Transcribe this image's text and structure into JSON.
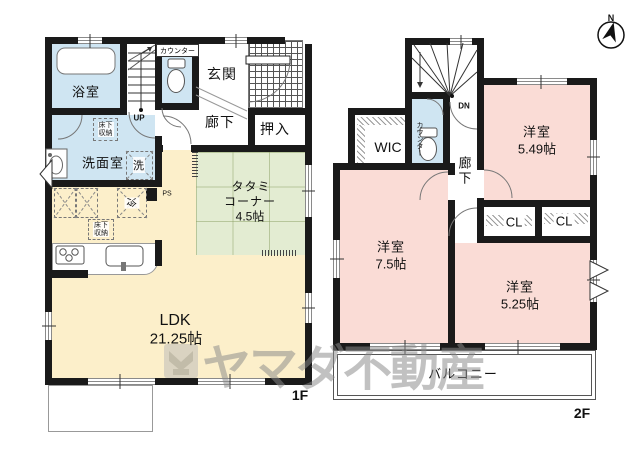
{
  "colors": {
    "wall": "#1a1a1a",
    "water_blue": "#cfe5f2",
    "tatami_green": "#e3ecd2",
    "ldk_cream": "#fcefca",
    "bedroom_pink": "#fadcd6",
    "watermark_gray": "#8a8a8a"
  },
  "compass": {
    "north_label": "N"
  },
  "watermark": {
    "company": "ヤマダ不動産"
  },
  "floor1": {
    "floor_label": "1F",
    "rooms": {
      "bathroom": "浴室",
      "washroom": "洗面室",
      "entrance": "玄関",
      "corridor": "廊下",
      "closet": "押入",
      "tatami_line1": "タタミ",
      "tatami_line2": "コーナー",
      "tatami_line3": "4.5帖",
      "ldk_line1": "LDK",
      "ldk_line2": "21.25帖"
    },
    "annotations": {
      "counter": "カウンター",
      "stairs_up": "UP",
      "pipe_space": "PS",
      "fridge": "冷",
      "washer": "洗",
      "underfloor_a_line1": "床下",
      "underfloor_a_line2": "収納",
      "underfloor_b_line1": "床下",
      "underfloor_b_line2": "収納"
    }
  },
  "floor2": {
    "floor_label": "2F",
    "rooms": {
      "western_a_line1": "洋室",
      "western_a_line2": "5.49帖",
      "western_b_line1": "洋室",
      "western_b_line2": "7.5帖",
      "western_c_line1": "洋室",
      "western_c_line2": "5.25帖",
      "wic": "WIC",
      "corridor": "廊下",
      "closet_a": "CL",
      "closet_b": "CL",
      "balcony": "バルコニー"
    },
    "annotations": {
      "stairs_down": "DN",
      "counter": "カウンター"
    }
  }
}
